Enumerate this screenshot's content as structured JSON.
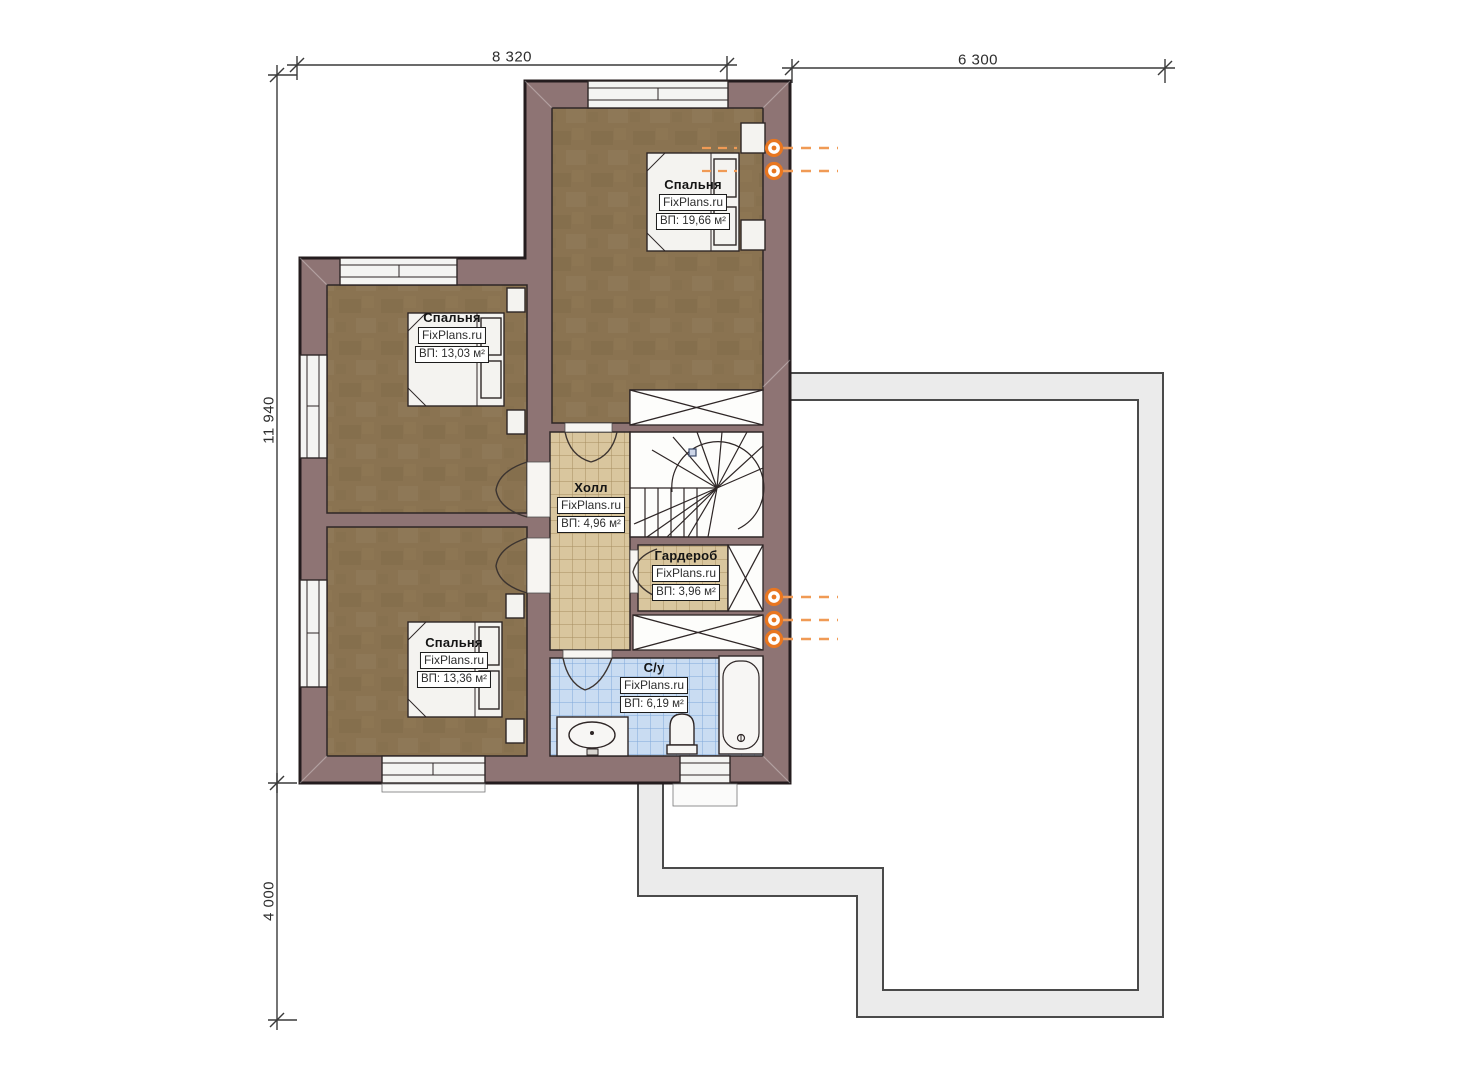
{
  "plan": {
    "title": "Second floor plan",
    "watermark": "FixPlans.ru",
    "dimensions": {
      "top_width": "8 320",
      "top_right_width": "6 300",
      "left_height": "11 940",
      "bottom_height": "4 000"
    },
    "rooms": [
      {
        "id": "bedroom-top-right",
        "name": "Спальня",
        "area": "ВП: 19,66 м²"
      },
      {
        "id": "bedroom-left-top",
        "name": "Спальня",
        "area": "ВП: 13,03 м²"
      },
      {
        "id": "bedroom-left-bottom",
        "name": "Спальня",
        "area": "ВП: 13,36 м²"
      },
      {
        "id": "hall",
        "name": "Холл",
        "area": "ВП: 4,96 м²"
      },
      {
        "id": "wardrobe",
        "name": "Гардероб",
        "area": "ВП: 3,96 м²"
      },
      {
        "id": "bathroom",
        "name": "С/у",
        "area": "ВП: 6,19 м²"
      }
    ],
    "colors": {
      "wall": "#8e7474",
      "wood_floor": "#8a7351",
      "tile_beige": "#d9c69e",
      "tile_blue": "#c9dcf2",
      "radiator": "#e87620",
      "lower_floor_outline": "#ebebeb"
    }
  }
}
